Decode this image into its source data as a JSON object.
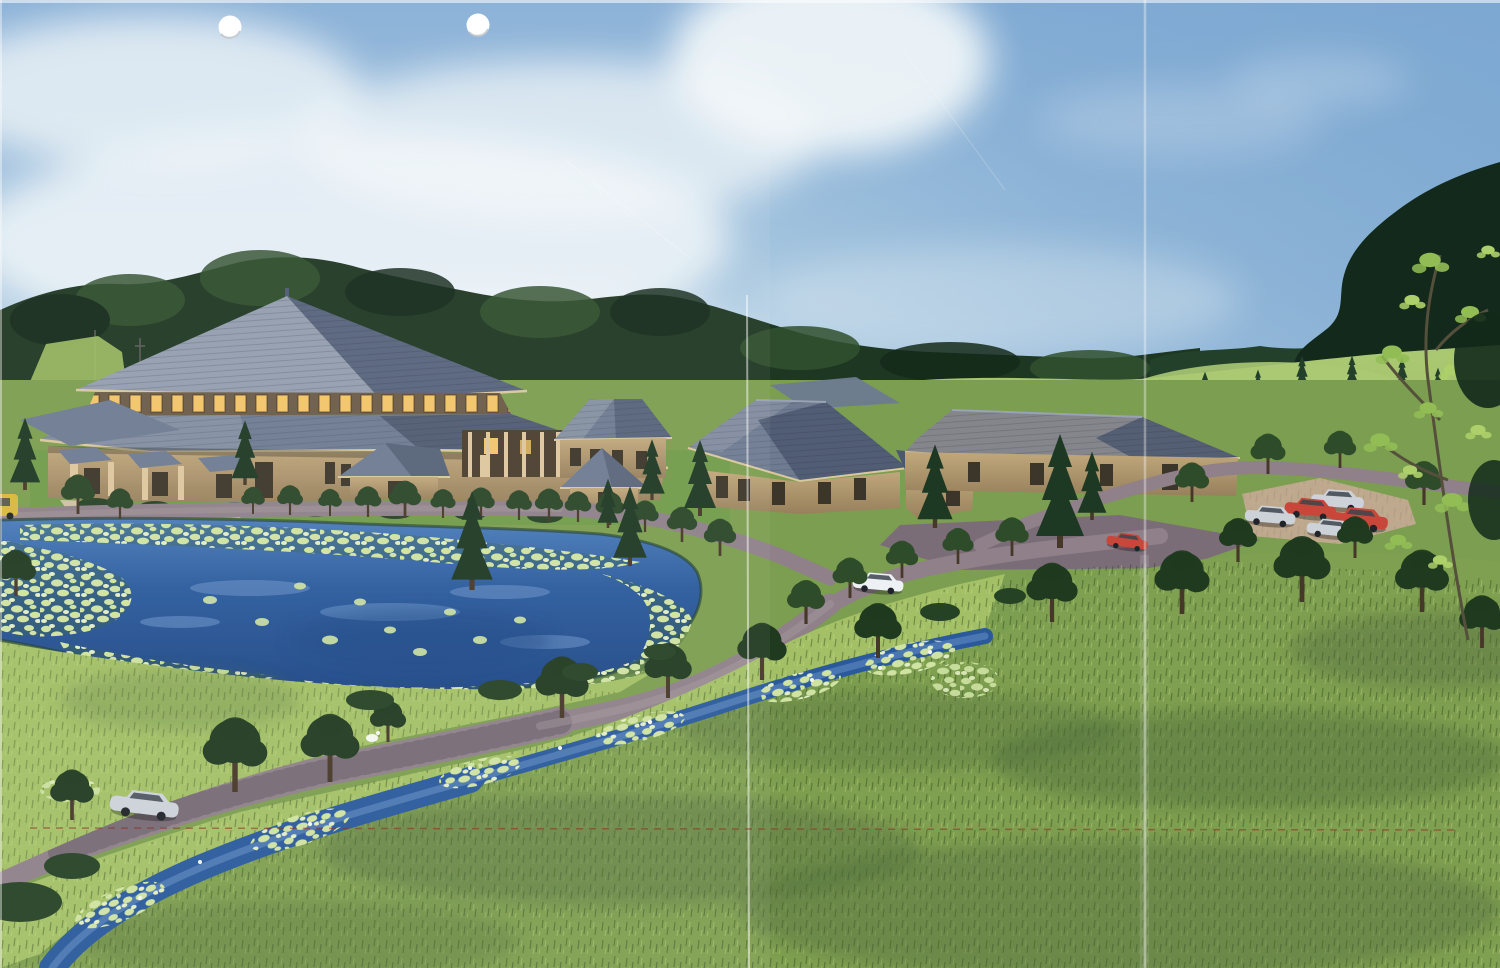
{
  "scene": {
    "kind": "scanned color architectural rendering, aerial view of a wooded campus",
    "hole_punches": 2,
    "buildings": {
      "main_hall": "large two-tier pyramidal hip-roof hall with lit clerestory windows, porches and columns",
      "entry_pavilion": 1,
      "cottages": 3,
      "garden_hut": 1
    },
    "water": {
      "pond": "large pond ringed with lily pads",
      "stream": "winding stream with lily pads and white blossoms"
    },
    "vehicles": {
      "parking_lot_cars": 5,
      "parking_red_cars": 2,
      "parking_silver_cars": 3,
      "white_car_on_road": 1,
      "silver_car_on_lower_road": 1,
      "yellow_vehicle_left_edge": 1,
      "red_vehicle_at_fold": 1
    },
    "landscape": {
      "tree_lined_roads": true,
      "background_forest": true,
      "meadow_hill_with_pines": true,
      "tall_grass_foreground": true
    },
    "scan_artifacts": {
      "vertical_fold_creases": 2,
      "red_dashed_survey_line": 1,
      "white_paper_edges": true
    }
  },
  "colors": {
    "sky_top": "#86aed6",
    "sky_mid": "#a9c8e0",
    "sky_haze": "#cfe0ec",
    "sky_right": "#7aa6d0",
    "cloud": "#f4f8fa",
    "forest": "#1e3722",
    "forest_shadow": "#152a1a",
    "forest_light": "#31512e",
    "pine": "#22402a",
    "far_trees": "#13291b",
    "leaf_light": "#92bd55",
    "leaf_bright": "#aed06a",
    "meadow": "#9dbc62",
    "meadow_bright": "#abc973",
    "ground": "#7c9e50",
    "lawn": "#6f9a48",
    "grass_bright": "#a3c066",
    "grass_fore": "#7fa050",
    "grass_dark": "#4e6a3c",
    "pond": "#2a5a9c",
    "pond_deep": "#1d4685",
    "pond_light": "#4a7cba",
    "water_streak": "#6a93c8",
    "pad": "#cfe3a2",
    "pad_light": "#e2eec4",
    "pad_tint": "#3a6140",
    "shore": "#1e3a28",
    "road": "#8f8089",
    "road_dark": "#605562",
    "road_light": "#a89aa0",
    "plaza": "#7b6d78",
    "parking": "#bfa98e",
    "roof_lit": "#939eae",
    "roof_mid": "#6e7b91",
    "roof_shadow": "#57647c",
    "roof_dark": "#4c586e",
    "roof_warm": "#85868c",
    "ridge": "#98a3b3",
    "fascia": "#d9c89e",
    "wall": "#c1a87c",
    "wall_shadow": "#97805c",
    "clere_bg": "#6a5b46",
    "window_dark": "#3b352a",
    "window_lit": "#f2c469",
    "column": "#ddc79f",
    "trunk": "#463829",
    "tree_row": "#2b4629",
    "tree_dark": "#203a20",
    "tree_mid": "#2e4c2a",
    "conifer": "#1d3823",
    "bush": "#254224",
    "car_red": "#c8473a",
    "car_silver": "#ccd2d8",
    "car_white": "#edf1f3",
    "car_yellow": "#d9b83e",
    "car_glass": "#3c444e",
    "crease": "#ffffff",
    "red_line": "#8e2f24",
    "hole": "#ffffff",
    "hole_rim": "#b9bfc4"
  }
}
